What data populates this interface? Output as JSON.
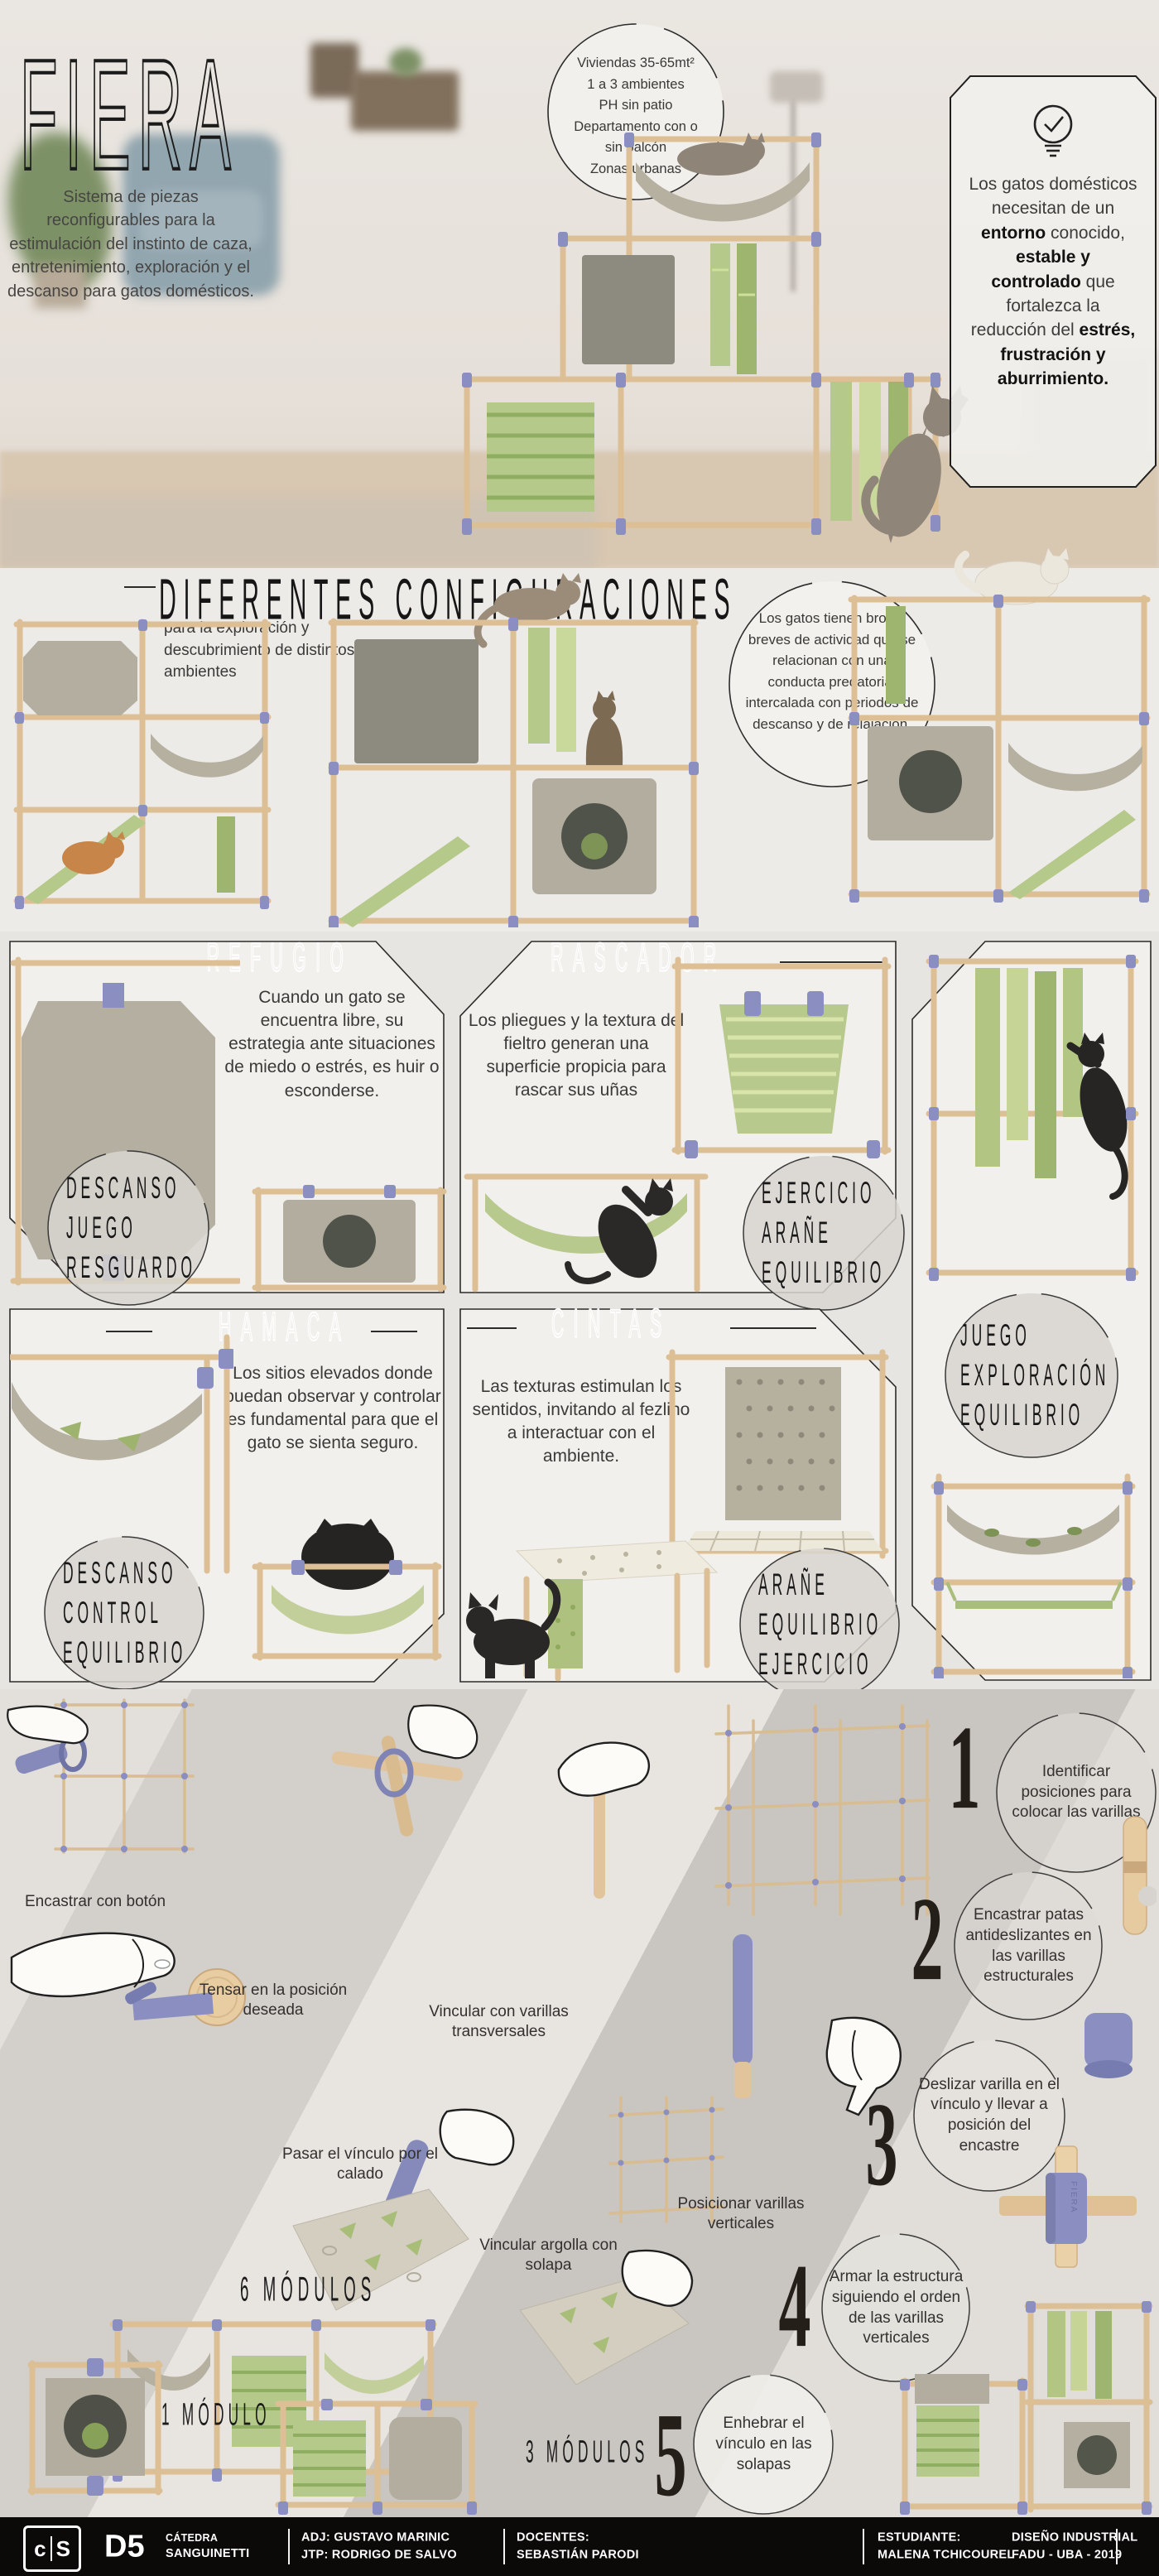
{
  "colors": {
    "accent_purple": "#8a8ec0",
    "felt_green": "#b5c98a",
    "wood": "#e2c49c",
    "felt_gray": "#b5b09f",
    "footer_bg": "#0b0a09"
  },
  "hero": {
    "title": "FIERA",
    "intro": "Sistema de piezas reconfigurables para la estimulación del instinto de caza, entretenimiento, exploración y el descanso para gatos domésticos.",
    "bubble": {
      "lines": [
        "Viviendas 35-65mt²",
        "1 a 3 ambientes",
        "PH sin patio",
        "Departamento con o sin balcón",
        "Zonas urbanas"
      ]
    },
    "tip": {
      "icon": "lightbulb-check-icon",
      "s0": "Los gatos domésticos necesitan de un ",
      "s1": "entorno",
      "s2": " conocido, ",
      "s3": "estable y controlado",
      "s4": " que fortalezca la reducción del ",
      "s5": "estrés, frustración y aburrimiento."
    }
  },
  "configs": {
    "title": "DIFERENTES CONFIGURACIONES",
    "subtitle": "para la exploración y descubrimiento de distintos ambientes",
    "bubble": "Los gatos tienen brotes breves de actividad que se relacionan con una conducta predatoria, intercalada con periodos de descanso y de relajación."
  },
  "features": {
    "refugio": {
      "title": "REFUGIO",
      "text": "Cuando un gato se encuentra libre, su estrategia ante situaciones de miedo o estrés, es huir o esconderse.",
      "stamp": [
        "DESCANSO",
        "JUEGO",
        "RESGUARDO"
      ]
    },
    "rascador": {
      "title": "RASCADOR",
      "text": "Los pliegues y la textura del fieltro generan una superficie propicia para rascar sus uñas",
      "stamp": [
        "EJERCICIO",
        "ARAÑE",
        "EQUILIBRIO"
      ]
    },
    "hamaca": {
      "title": "HAMACA",
      "text": "Los sitios elevados donde puedan observar y controlar es fundamental para que el gato se sienta seguro.",
      "stamp": [
        "DESCANSO",
        "CONTROL",
        "EQUILIBRIO"
      ]
    },
    "cintas": {
      "title": "CINTAS",
      "text": "Las texturas estimulan los sentidos, invitando al fezlino a interactuar con el ambiente.",
      "stamp": [
        "ARAÑE",
        "EQUILIBRIO",
        "EJERCICIO"
      ]
    },
    "side_stamp": [
      "JUEGO",
      "EXPLORACIÓN",
      "EQUILIBRIO"
    ]
  },
  "assembly": {
    "labels": {
      "encastrar": "Encastrar con botón",
      "tensar": "Tensar en la posición deseada",
      "vincular_varillas": "Vincular con varillas transversales",
      "pasar": "Pasar el vínculo por el calado",
      "vincular_argolla": "Vincular argolla con solapa",
      "posicionar": "Posicionar varillas verticales",
      "modulos6": "6 MÓDULOS",
      "modulo1": "1 MÓDULO",
      "modulos3": "3 MÓDULOS"
    },
    "connector_brand": "FIERA",
    "steps": [
      {
        "num": "1",
        "text": "Identificar posiciones para colocar las varillas"
      },
      {
        "num": "2",
        "text": "Encastrar patas antideslizantes en las varillas estructurales"
      },
      {
        "num": "3",
        "text": "Deslizar varilla en el vínculo y llevar a posición del encastre"
      },
      {
        "num": "4",
        "text": "Armar la estructura siguiendo el orden de las varillas verticales"
      },
      {
        "num": "5",
        "text": "Enhebrar el vínculo en las solapas"
      }
    ]
  },
  "footer": {
    "logo_c": "c",
    "logo_s": "S",
    "code": "D5",
    "catedra_label": "CÁTEDRA",
    "catedra": "SANGUINETTI",
    "adj": "ADJ: GUSTAVO MARINIC",
    "jtp": "JTP: RODRIGO DE SALVO",
    "docentes_label": "DOCENTES:",
    "docente": "SEBASTIÁN PARODI",
    "estudiante_label": "ESTUDIANTE:",
    "estudiante": "MALENA TCHICOUREL",
    "carrera": "DISEÑO INDUSTRIAL",
    "institucion": "FADU - UBA - 2019"
  }
}
